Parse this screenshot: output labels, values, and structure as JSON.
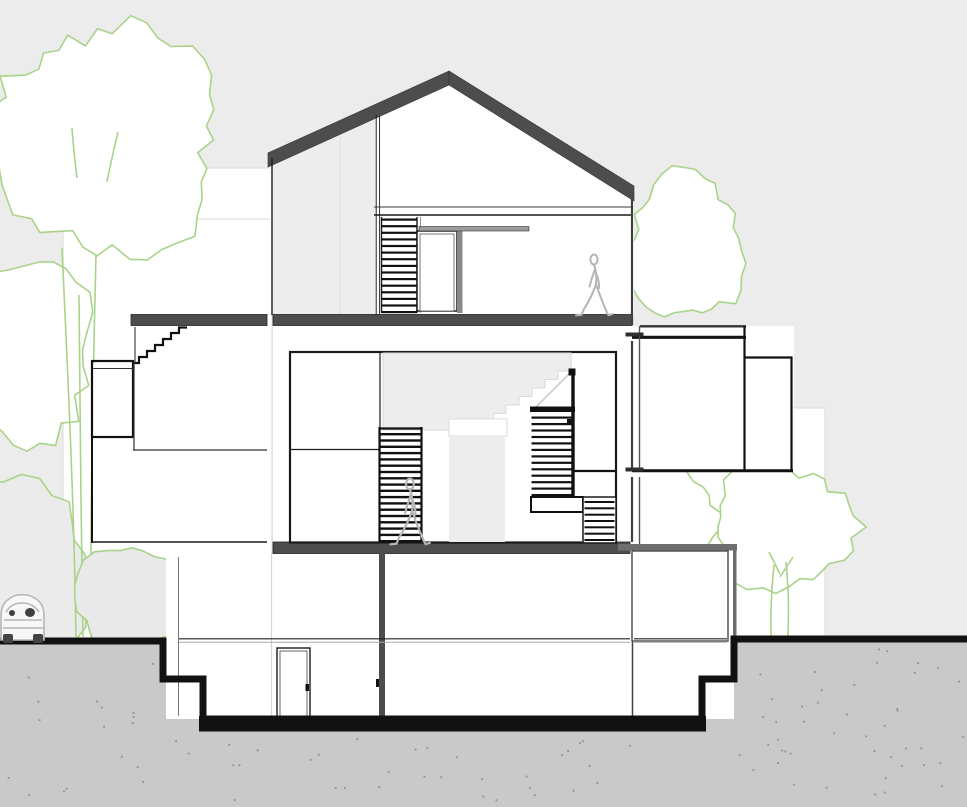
{
  "meta": {
    "description": "Architectural cross-section drawing of a three-storey house with basement, gabled roof, interior stairs, two walking figures, surrounding trees and a parked car",
    "visible_text": []
  },
  "colors": {
    "background": "#ececec",
    "paper_white": "#ffffff",
    "backdrop_border": "#dedede",
    "ground": "#c9c9c9",
    "ground_dot": "#8f8f8f",
    "terrain": "#111111",
    "roof_slab": "#4d4d4d",
    "line_black": "#1a1a1a",
    "line_gray": "#555555",
    "interior_gray": "#ededed",
    "ghost_gray": "#d9d9d9",
    "tree_green": "#a9d389",
    "bush_fill": "#e9e9e9",
    "figure_gray": "#b5b5b5",
    "beam_gray": "#9c9c9c",
    "jamb_gray": "#8a8a8a",
    "annex_gray": "#6e6e6e"
  },
  "scene": {
    "building": {
      "label": "sectioned house"
    },
    "figures": [
      {
        "label": "person walking on upper floor"
      },
      {
        "label": "person walking on main floor"
      }
    ],
    "vehicle": {
      "label": "parked car at street"
    },
    "trees": [
      {
        "label": "large tree left"
      },
      {
        "label": "tall tree right of house"
      },
      {
        "label": "round tree lower right"
      },
      {
        "label": "bushes lower left"
      }
    ]
  }
}
